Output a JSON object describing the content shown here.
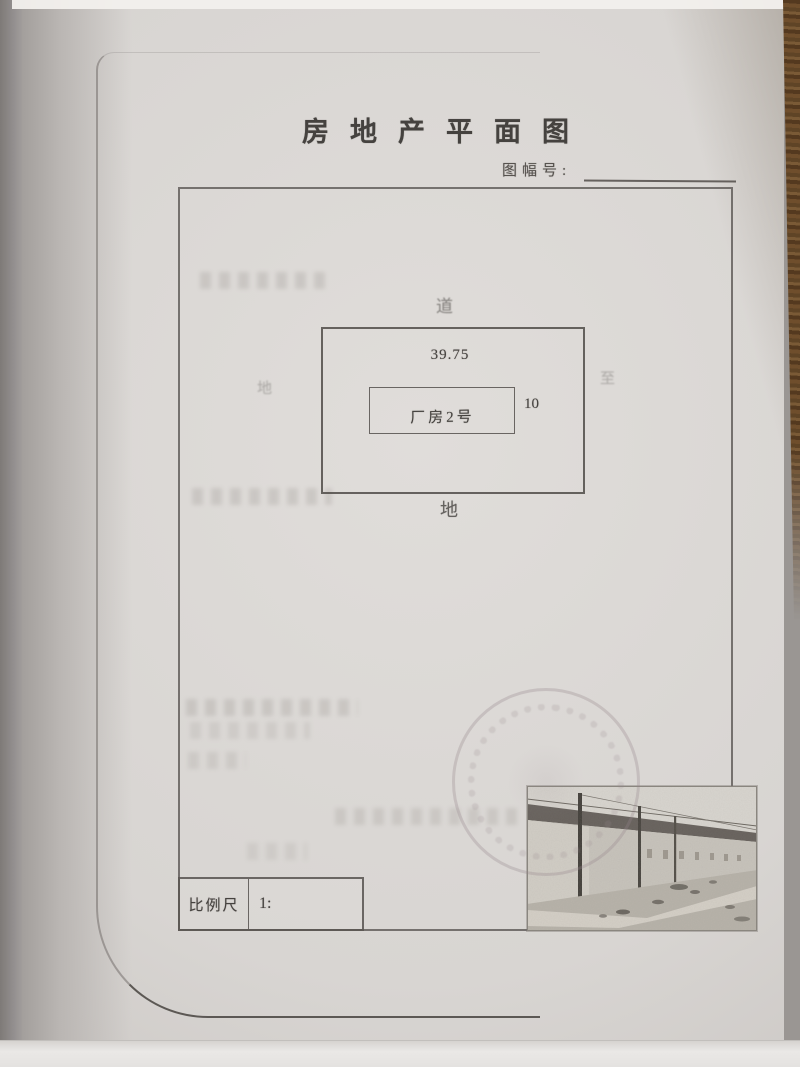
{
  "document": {
    "title": "房地产平面图",
    "sheet_no": {
      "label": "图幅号:",
      "value": ""
    },
    "plan": {
      "road_top_label": "道",
      "land_bottom_label": "地",
      "land_left_label": "地",
      "land_right_label": "至",
      "dim_width": "39.75",
      "dim_depth": "10",
      "building_label": "厂房2号"
    },
    "scale": {
      "label": "比例尺",
      "value": "1:"
    }
  },
  "colors": {
    "ink": "#45423f",
    "paper": "#d8d5d2",
    "wood_desk": "#6f4e2c",
    "stamp": "#968a8e"
  }
}
